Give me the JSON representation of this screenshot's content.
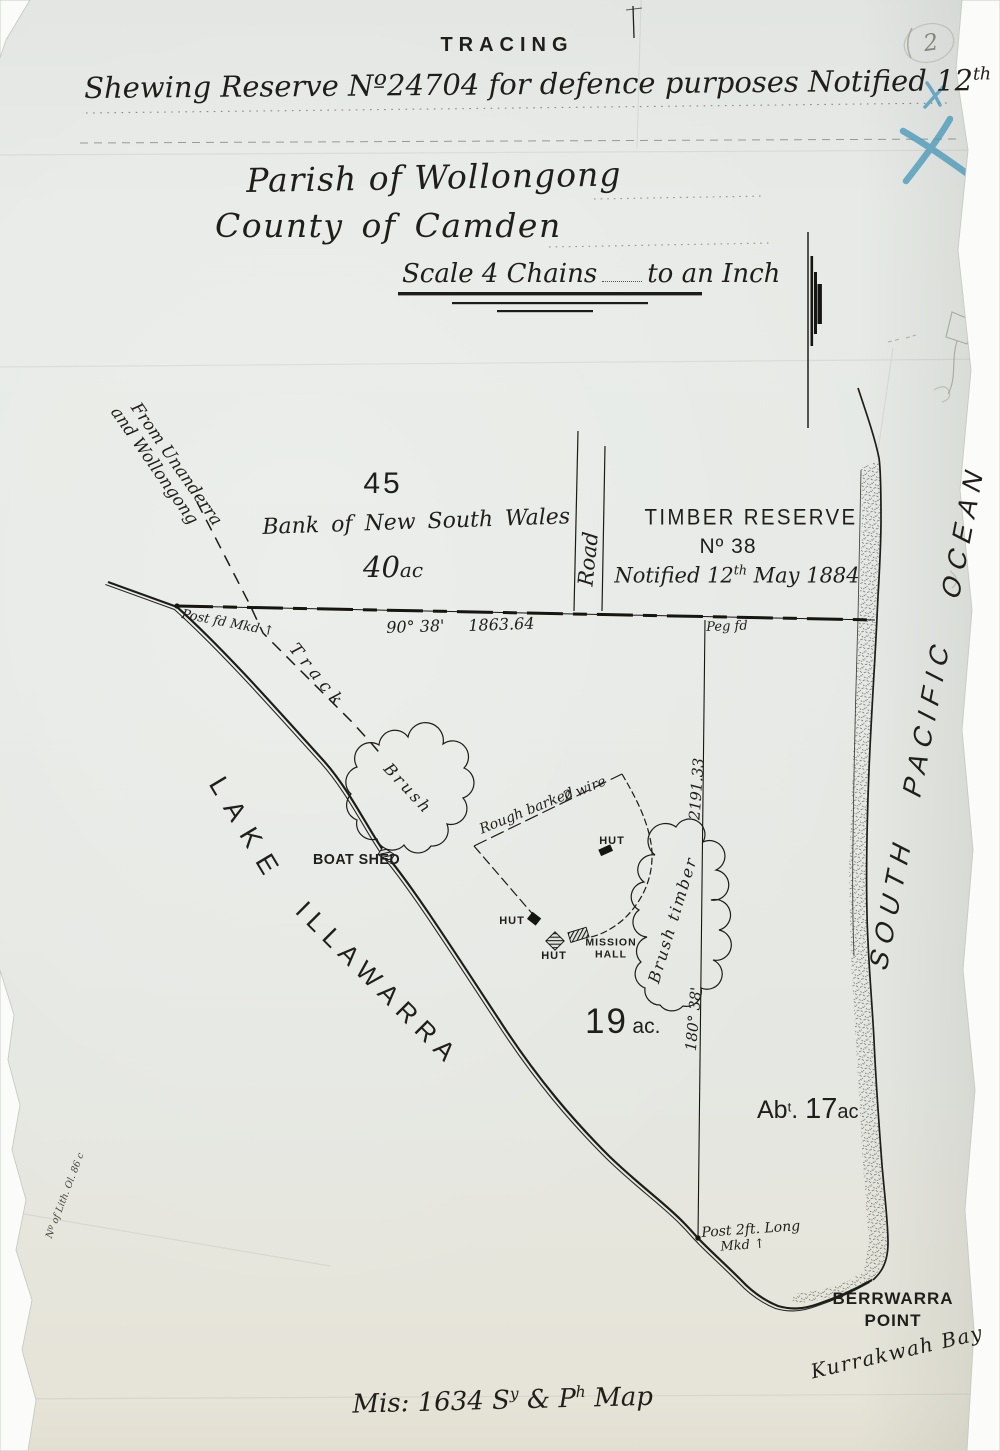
{
  "colors": {
    "ink": "#1d1c18",
    "blue_pencil": "#4e9bbc",
    "paper": "#e6e9e5",
    "pencil": "#9b9e92"
  },
  "document": {
    "type_label": "TRACING",
    "subtitle": {
      "p1": "Shewing Reserve Nº24704 for defence purposes Notified 12",
      "s1": "th",
      "p2": " Sep",
      "s2": "tr",
      "p3": " 1896"
    },
    "parish": "Parish of Wollongong",
    "county": "County of Camden",
    "scale": {
      "p1": "Scale 4 Chains",
      "p2": "to an Inch"
    },
    "footer": {
      "p1": "Mis: 1634 S",
      "s1": "y",
      "p2": " & P",
      "s2": "h",
      "p3": " Map"
    },
    "lith_note": "Nº of Lith. Ol. 86 c"
  },
  "annotations": {
    "page_number": "2"
  },
  "map": {
    "parcel_45": {
      "number": "45",
      "owner": "Bank of New South Wales",
      "area_num": "40",
      "area_unit": "ac"
    },
    "timber_reserve": {
      "name": "TIMBER RESERVE",
      "number": "Nº 38",
      "notified": {
        "p1": "Notified 12",
        "s1": "th",
        "p2": " May 1884"
      }
    },
    "road": "Road",
    "north_boundary": {
      "bearing": "90° 38'",
      "distance": "1863.64",
      "post_label": "Post fd Mkd ↑",
      "peg_label": "Peg fd"
    },
    "east_boundary": {
      "distance": "2191.33",
      "bearing": "180° 38'"
    },
    "track": {
      "origin_line1": "From Unanderra",
      "origin_line2": "and Wollongong",
      "label": "Track"
    },
    "lake": {
      "word1": "LAKE",
      "word2": "ILLAWARRA"
    },
    "features": {
      "brush": "Brush",
      "brush_timber": "Brush timber",
      "boat_shed": "BOAT SHED",
      "hut_a": "HUT",
      "hut_b": "HUT",
      "hut_c": "HUT",
      "mission_hall_1": "MISSION",
      "mission_hall_2": "HALL",
      "fence_label_1": "Rough barked",
      "fence_label_2": "2 wire"
    },
    "parcel_19": {
      "num": "19",
      "unit": "ac."
    },
    "parcel_17": {
      "p1": "Ab",
      "s1": "t",
      "p2": ". ",
      "num": "17",
      "unit": "ac"
    },
    "south_post": {
      "line1": "Post 2ft. Long",
      "line2": "Mkd ↑"
    },
    "coast": {
      "point_line1": "BERRWARRA",
      "point_line2": "POINT",
      "bay": "Kurrakwah Bay",
      "ocean": "SOUTH PACIFIC OCEAN"
    }
  }
}
